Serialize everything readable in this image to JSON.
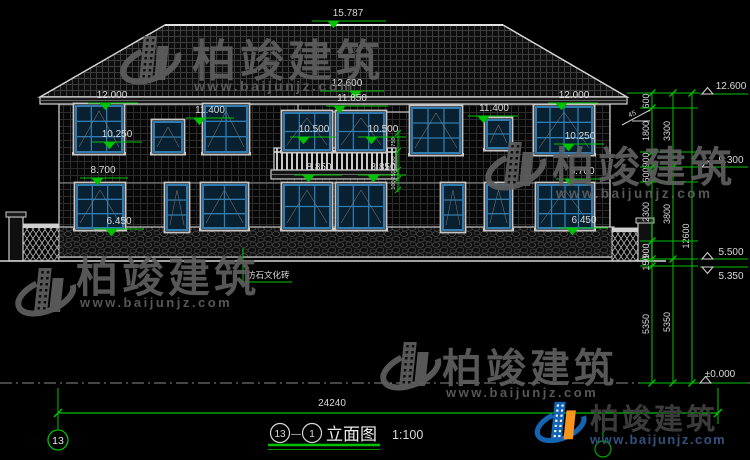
{
  "watermark": {
    "brand": "柏竣建筑",
    "url": "www.baijunjz.com"
  },
  "logo": {
    "brand": "柏竣建筑",
    "url": "www.baijunjz.com"
  },
  "title": {
    "axis_from": "13",
    "axis_to": "1",
    "name": "立面图",
    "scale": "1:100",
    "separator": "—"
  },
  "axis": {
    "bubble": "13"
  },
  "annotations": {
    "stone_leader": "仿石文化砖"
  },
  "dims": {
    "ridge": "15.787",
    "total_width": "24240",
    "center": {
      "upper": "12.600",
      "lower": "11.850"
    },
    "left_bay": {
      "eave": "12.000",
      "upper_win": "11.400",
      "upper_sill": "10.250",
      "lower_win": "8.700",
      "lower_sill": "6.450"
    },
    "right_bay": {
      "eave": "12.000",
      "upper_win": "11.400",
      "upper_sill": "10.250",
      "lower_win": "8.700",
      "lower_sill": "6.450"
    },
    "balcony": {
      "win_left": "10.500",
      "win_right": "10.500",
      "floor_left": "8.850",
      "floor_right": "8.850"
    },
    "right_markers": {
      "eave": "12.600",
      "mid": "9.300",
      "terrace": "5.500",
      "ground": "5.350",
      "datum": "±0.000"
    },
    "chain1": [
      "600",
      "1800",
      "900",
      "600",
      "2300",
      "900",
      "150",
      "5350"
    ],
    "chain2": [
      "3300",
      "3800",
      "5350"
    ],
    "chain3": [
      "12600"
    ],
    "balcony_chain": [
      "750",
      "900",
      "250",
      "100"
    ],
    "slope": "45"
  },
  "colors": {
    "dim_green": "#00c300",
    "frame_blue": "#2f7cb2",
    "logo_blue": "#1464b4",
    "logo_orange": "#f7941d"
  }
}
